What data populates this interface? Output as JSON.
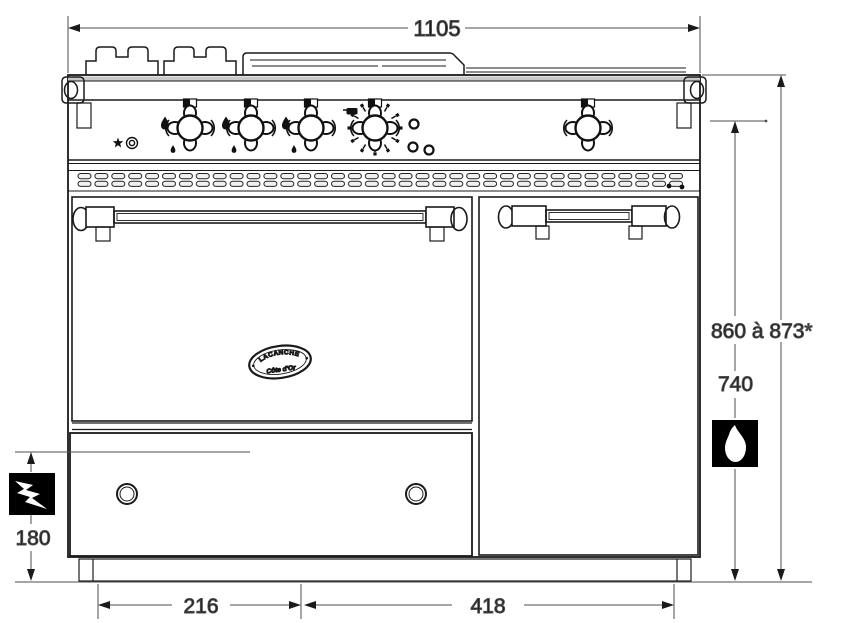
{
  "page": {
    "type": "technical-drawing",
    "subject": "range-cooker-front-elevation"
  },
  "dimensions": {
    "total_width_mm": "1105",
    "overall_height_mm": "860 à 873*",
    "body_height_mm": "740",
    "drawer_height_mm": "180",
    "left_section_width_mm": "216",
    "right_section_width_mm": "418"
  },
  "badge": {
    "brand": "LACANCHE",
    "origin": "Côte d'Or"
  },
  "icons": {
    "electric": "lightning-icon",
    "gas": "flame-icon"
  },
  "colors": {
    "line": "#1a1a1a",
    "dim_line": "#4d4d4d",
    "background": "#ffffff",
    "icon_background": "#000000"
  }
}
